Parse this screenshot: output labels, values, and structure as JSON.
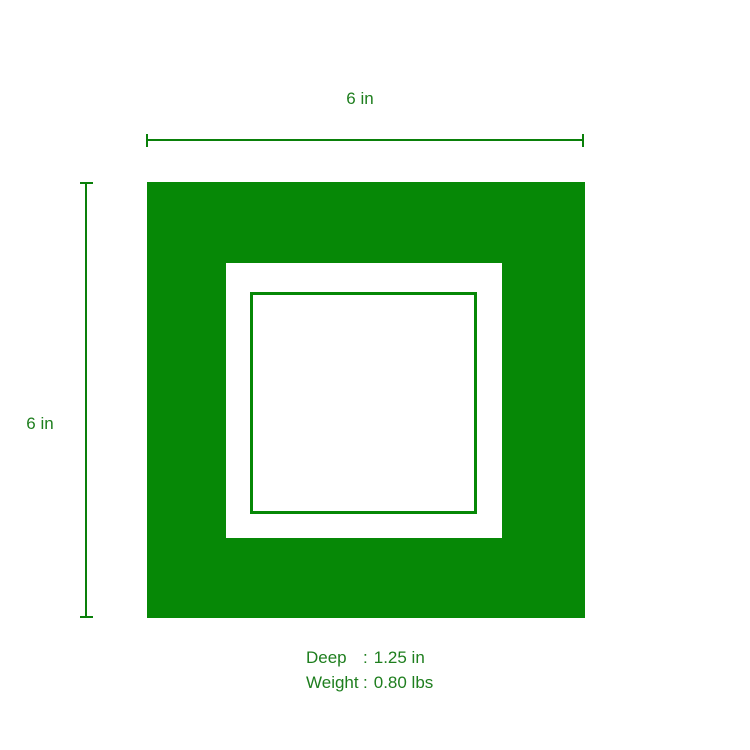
{
  "diagram": {
    "top_dimension": {
      "label": "6 in"
    },
    "side_dimension": {
      "label": "6 in"
    },
    "specs": {
      "rows": [
        {
          "label": "Deep",
          "separator": ":",
          "value": "1.25 in"
        },
        {
          "label": "Weight",
          "separator": ":",
          "value": "0.80 lbs"
        }
      ]
    },
    "colors": {
      "shape_green": "#068806",
      "line_green": "#0a800a",
      "text_green": "#1e7e1e",
      "background": "#ffffff"
    }
  }
}
